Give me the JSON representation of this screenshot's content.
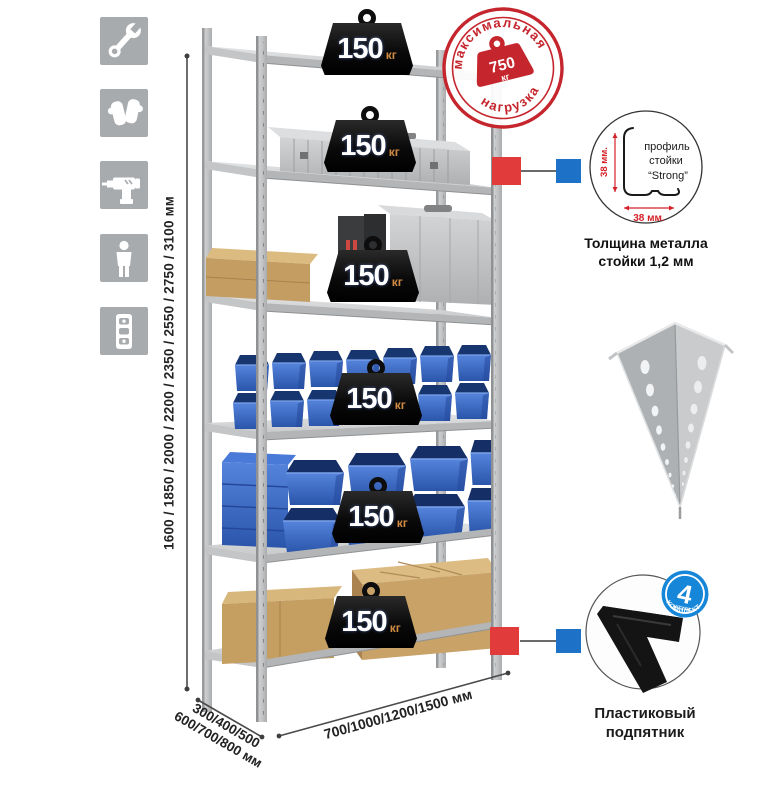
{
  "assembly_icons": [
    {
      "icon": "wrench-icon"
    },
    {
      "icon": "gloves-icon"
    },
    {
      "icon": "drill-icon"
    },
    {
      "icon": "person-icon"
    },
    {
      "icon": "level-icon"
    }
  ],
  "dimensions": {
    "height": "1600 / 1850 / 2000 / 2200 / 2350 / 2550 / 2750 / 3100 мм",
    "depth_line1": "300/400/500",
    "depth_line2": "600/700/800 мм",
    "width": "700/1000/1200/1500 мм"
  },
  "max_load_stamp": {
    "arc_top": "максимальная",
    "arc_bottom": "нагрузка",
    "value": "750",
    "unit": "кг"
  },
  "shelf_loads": [
    {
      "value": "150",
      "unit": "кг"
    },
    {
      "value": "150",
      "unit": "кг"
    },
    {
      "value": "150",
      "unit": "кг"
    },
    {
      "value": "150",
      "unit": "кг"
    },
    {
      "value": "150",
      "unit": "кг"
    },
    {
      "value": "150",
      "unit": "кг"
    }
  ],
  "profile_detail": {
    "vertical_dim": "38 мм.",
    "horizontal_dim": "38 мм.",
    "line1": "профиль",
    "line2": "стойки",
    "line3": "“Strong”",
    "caption1": "Толщина металла",
    "caption2": "стойки 1,2 мм"
  },
  "foot_detail": {
    "badge_value": "4",
    "badge_small": "штуки",
    "badge_arc": "в комплекте",
    "caption1": "Пластиковый",
    "caption2": "подпятник"
  },
  "colors": {
    "stamp_red": "#c5262d",
    "badge_blue": "#1686d8",
    "connector_red": "#e23b3c",
    "connector_blue": "#1d72c8",
    "bin_blue": "#3a67c8",
    "unit_orange": "#cf8b43",
    "metal_gray": "#c6c8ca"
  }
}
